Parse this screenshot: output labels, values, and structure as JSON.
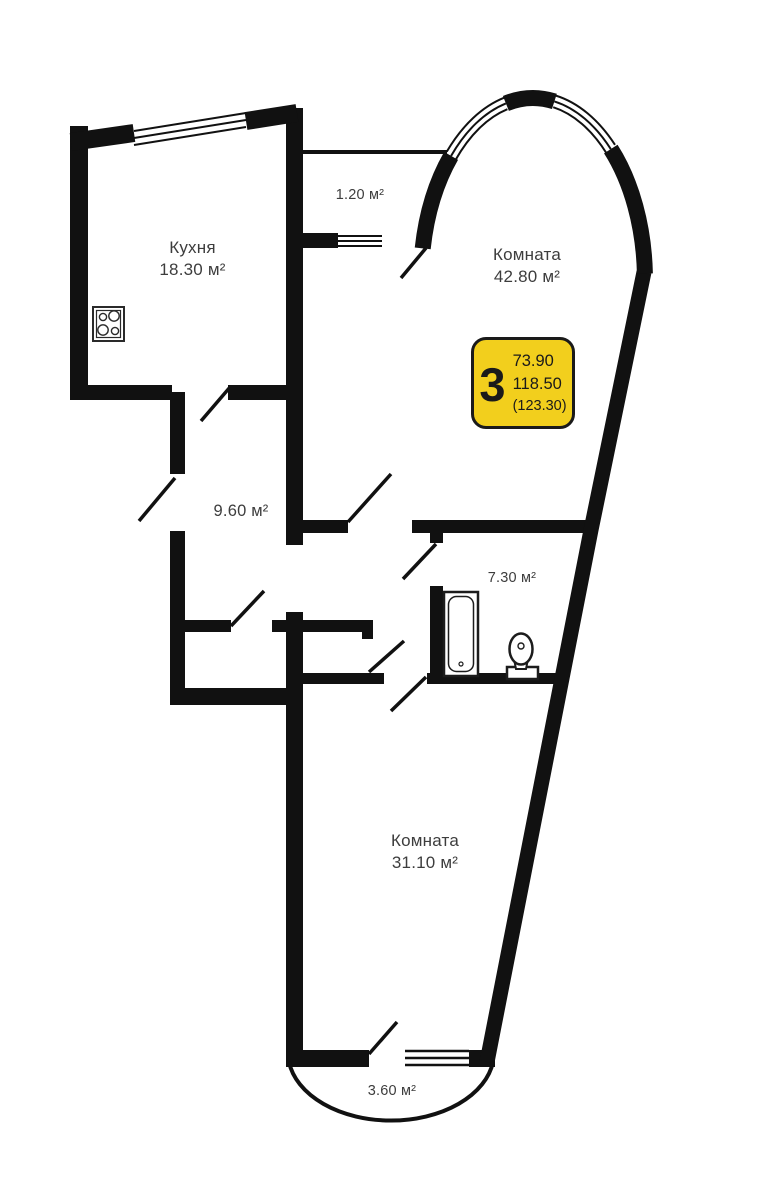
{
  "rooms": {
    "kitchen": {
      "name": "Кухня",
      "area": "18.30 м²"
    },
    "room_top": {
      "name": "Комната",
      "area": "42.80 м²"
    },
    "hallway": {
      "area": "9.60 м²"
    },
    "bathroom": {
      "area": "7.30 м²"
    },
    "room_bottom": {
      "name": "Комната",
      "area": "31.10 м²"
    },
    "balcony_top": {
      "area": "1.20 м²"
    },
    "balcony_bottom": {
      "area": "3.60 м²"
    }
  },
  "badge": {
    "rooms_count": "3",
    "living_area": "73.90",
    "total_area": "118.50",
    "area_with_balcony": "(123.30)"
  },
  "fixtures": {
    "stove": "stove-icon",
    "bathtub": "bathtub-icon",
    "toilet": "toilet-icon"
  },
  "colors": {
    "wall": "#111111",
    "badge_fill": "#F2CF1D",
    "badge_border": "#1A1A1A",
    "label_text": "#3D3D3D"
  }
}
